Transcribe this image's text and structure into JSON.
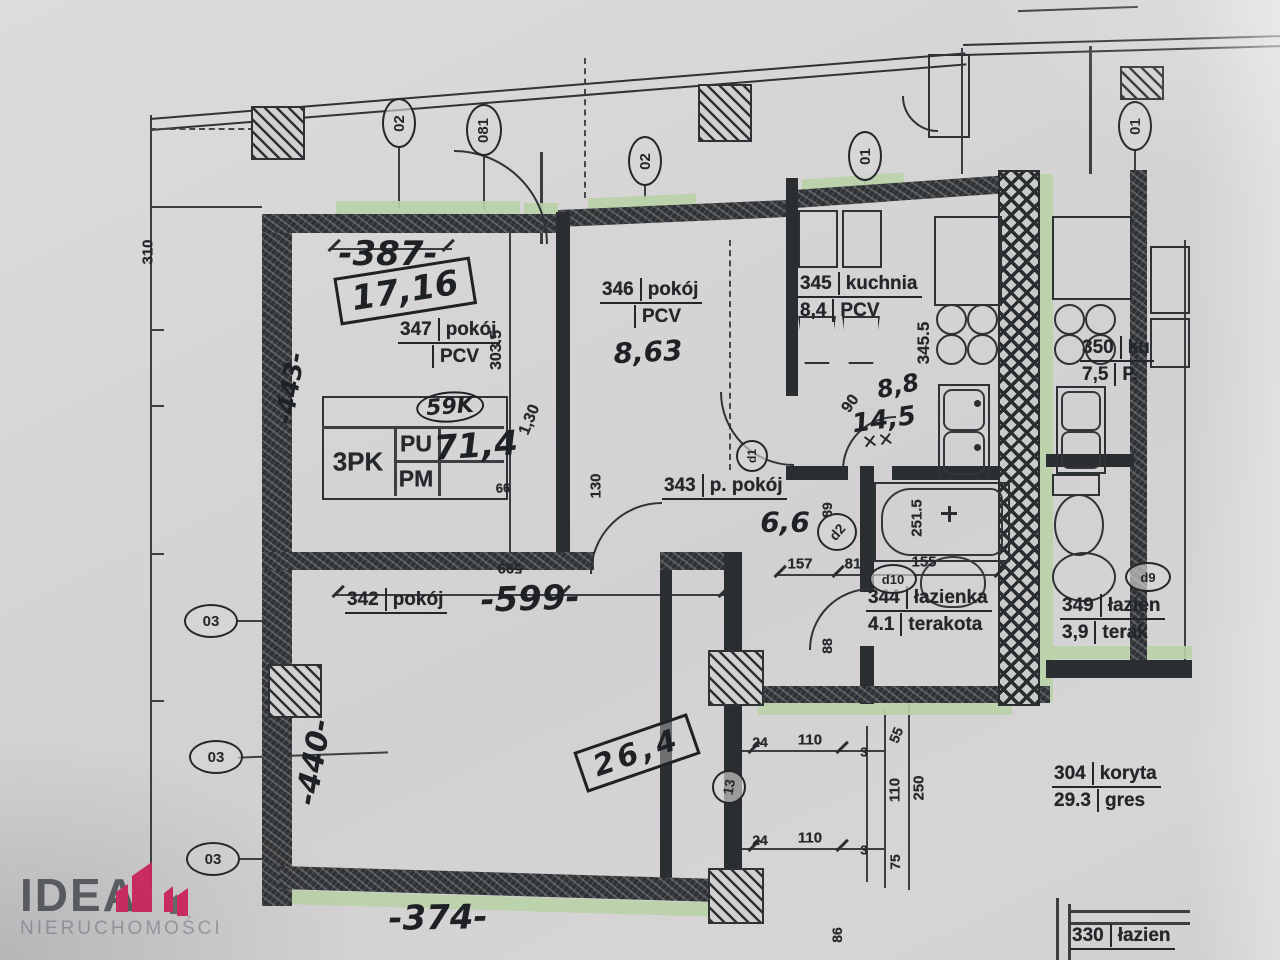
{
  "watermark": {
    "brand": "IDEA",
    "subtitle": "NIERUCHOMOŚCI"
  },
  "colors": {
    "paper": "#d6d4d5",
    "ink": "#2b2e30",
    "window_green": "#b9d2a7",
    "logo_accent": "#d6215d",
    "logo_text": "#54585c",
    "logo_sub": "#989da1"
  },
  "rooms": {
    "r347": {
      "num": "347",
      "name": "pokój",
      "area": "",
      "floor": "PCV"
    },
    "r346": {
      "num": "346",
      "name": "pokój",
      "area": "",
      "floor": "PCV"
    },
    "r345": {
      "num": "345",
      "name": "kuchnia",
      "area": "8,4",
      "floor": "PCV"
    },
    "r350": {
      "num": "350",
      "name": "ku",
      "area": "7,5",
      "floor": "P."
    },
    "r343": {
      "num": "343",
      "name": "p. pokój"
    },
    "r342": {
      "num": "342",
      "name": "pokój"
    },
    "r344": {
      "num": "344",
      "name": "łazienka",
      "area": "4.1",
      "floor": "terakota"
    },
    "r349": {
      "num": "349",
      "name": "łazien",
      "area": "3,9",
      "floor": "terak"
    },
    "r304": {
      "num": "304",
      "name": "koryta",
      "area": "29.3",
      "floor": "gres"
    },
    "r330": {
      "num": "330",
      "name": "łazien"
    }
  },
  "handwritten": {
    "dim387": "-387-",
    "area1716": "17,16",
    "circ59k": "59K",
    "area714": "71,4",
    "area863": "8,63",
    "area66": "6,6",
    "dim599": "-599-",
    "area264": "26,4",
    "dim374": "-374-",
    "dim440": "-440-",
    "dim443": "-443-",
    "area88": "8,8",
    "dim145": "14,5",
    "strike": "✕✕"
  },
  "legend_table": {
    "type": "3PK",
    "pu": "PU",
    "pm": "PM"
  },
  "dims": {
    "d310": "310",
    "d3035": "303.5",
    "d3455": "345.5",
    "d130a": "1,30",
    "d130b": "130",
    "d599": "599",
    "d99": "99",
    "d90": "90",
    "d89": "89",
    "d88": "88",
    "d157": "157",
    "d81": "81",
    "d155": "155",
    "d2515": "251.5",
    "d55": "55",
    "d24a": "24",
    "d110a": "110",
    "d3a": "3",
    "d110v": "110",
    "d250": "250",
    "d24b": "24",
    "d110b": "110",
    "d3b": "3",
    "d75": "75",
    "d86": "86"
  },
  "axis_markers": {
    "top1": "02",
    "top2": "081",
    "top3": "02",
    "top4": "01",
    "right": "01",
    "left1": "03",
    "left2": "03",
    "left3": "03"
  },
  "door_markers": {
    "d1": "d1",
    "d2": "d2",
    "d10": "d10",
    "d9": "d9",
    "d13": "13"
  }
}
